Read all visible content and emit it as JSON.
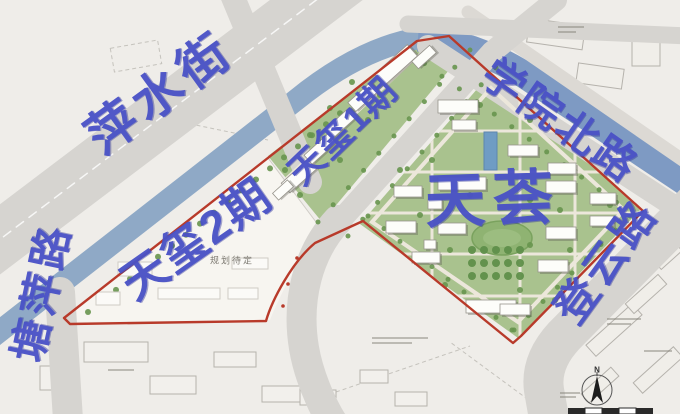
{
  "map": {
    "labels": [
      {
        "id": "pingshui-street",
        "text": "萍水街",
        "x": 160,
        "y": 93,
        "rot": -36,
        "size": 50,
        "ls": 6
      },
      {
        "id": "tangping-road",
        "text": "塘萍路",
        "x": 42,
        "y": 292,
        "rot": -78,
        "size": 42,
        "ls": 5
      },
      {
        "id": "xueyuan-north-road",
        "text": "学院北路",
        "x": 560,
        "y": 121,
        "rot": 35,
        "size": 42,
        "ls": 3
      },
      {
        "id": "dengyun-road",
        "text": "登云路",
        "x": 607,
        "y": 262,
        "rot": -54,
        "size": 43,
        "ls": 4
      },
      {
        "id": "tianxi-phase-2",
        "text": "天玺2期",
        "x": 196,
        "y": 239,
        "rot": -35,
        "size": 46,
        "ls": 2
      },
      {
        "id": "tianxi-phase-1",
        "text": "天玺1期",
        "x": 343,
        "y": 131,
        "rot": -44,
        "size": 36,
        "ls": 2
      },
      {
        "id": "tianhui",
        "text": "天荟",
        "x": 493,
        "y": 200,
        "rot": -2,
        "size": 60,
        "ls": 8
      }
    ],
    "annotations": {
      "pending": "规划待定"
    },
    "compass": {
      "north": "N"
    },
    "colors": {
      "bg": "#efede9",
      "road": "#d6d4d0",
      "river1": "#8fa9c6",
      "river2": "#7e9ac3",
      "green": "#a9c28e",
      "tree": "#67954e",
      "bldg": "#fdfdfa",
      "bstroke": "#97948c",
      "red": "#b83a2a",
      "blue": "#4a52c6",
      "path": "#ece7db",
      "pool": "#6f9cc4",
      "oval": "#8fb372",
      "white2": "#f7f5f0",
      "ctx": "#b5b2ac",
      "dash": "#b3b0aa"
    },
    "features": {
      "tianhui_buildings": [
        [
          438,
          100,
          40,
          13
        ],
        [
          452,
          120,
          24,
          10
        ],
        [
          508,
          145,
          30,
          11
        ],
        [
          548,
          163,
          28,
          11
        ],
        [
          590,
          193,
          26,
          11
        ],
        [
          394,
          186,
          28,
          11
        ],
        [
          438,
          177,
          48,
          13
        ],
        [
          546,
          181,
          30,
          12
        ],
        [
          386,
          221,
          30,
          12
        ],
        [
          438,
          223,
          28,
          11
        ],
        [
          546,
          227,
          30,
          12
        ],
        [
          590,
          216,
          24,
          10
        ],
        [
          412,
          252,
          28,
          11
        ],
        [
          538,
          260,
          30,
          12
        ],
        [
          466,
          300,
          50,
          13
        ],
        [
          500,
          304,
          30,
          11
        ],
        [
          428,
          199,
          14,
          10
        ],
        [
          424,
          240,
          12,
          9
        ]
      ],
      "tianxi1_buildings": [
        [
          299,
          176,
          36,
          13
        ],
        [
          320,
          149,
          32,
          12
        ],
        [
          341,
          123,
          32,
          12
        ],
        [
          363,
          97,
          30,
          12
        ],
        [
          396,
          65,
          44,
          15
        ],
        [
          424,
          57,
          24,
          10
        ],
        [
          283,
          190,
          20,
          9
        ]
      ],
      "future_outlines": [
        [
          118,
          262,
          34,
          14
        ],
        [
          158,
          288,
          62,
          11
        ],
        [
          228,
          288,
          30,
          11
        ],
        [
          96,
          292,
          24,
          13
        ],
        [
          232,
          258,
          36,
          11
        ]
      ],
      "context_buildings": [
        [
          84,
          342,
          64,
          20
        ],
        [
          40,
          366,
          30,
          24
        ],
        [
          150,
          376,
          46,
          18
        ],
        [
          214,
          352,
          42,
          15
        ],
        [
          262,
          386,
          38,
          16
        ],
        [
          300,
          390,
          36,
          15
        ],
        [
          360,
          370,
          28,
          13
        ],
        [
          395,
          392,
          32,
          14
        ]
      ],
      "context_buildings_rot": [
        [
          614,
          330,
          62,
          15,
          -42
        ],
        [
          646,
          294,
          44,
          13,
          -42
        ],
        [
          658,
          370,
          54,
          14,
          -42
        ],
        [
          600,
          385,
          40,
          12,
          -42
        ],
        [
          668,
          256,
          28,
          11,
          -42
        ],
        [
          556,
          34,
          56,
          24,
          8
        ],
        [
          600,
          76,
          46,
          20,
          8
        ],
        [
          646,
          48,
          28,
          36,
          0
        ]
      ],
      "tree_lines": [
        {
          "from": [
            88,
            312
          ],
          "to": [
            410,
            58
          ],
          "n": 24,
          "r": 3
        },
        {
          "from": [
            318,
            222
          ],
          "to": [
            470,
            50
          ],
          "n": 11,
          "r": 2.5
        },
        {
          "from": [
            348,
            236
          ],
          "to": [
            496,
            68
          ],
          "n": 11,
          "r": 2.5
        },
        {
          "from": [
            407,
            51
          ],
          "to": [
            634,
            215
          ],
          "n": 14,
          "r": 2.5
        },
        {
          "from": [
            630,
            216
          ],
          "to": [
            514,
            330
          ],
          "n": 9,
          "r": 2.5
        },
        {
          "from": [
            368,
            216
          ],
          "to": [
            512,
            330
          ],
          "n": 10,
          "r": 2.5
        }
      ],
      "tree_spots": [
        [
          400,
          170
        ],
        [
          432,
          160
        ],
        [
          470,
          195
        ],
        [
          530,
          200
        ],
        [
          560,
          210
        ],
        [
          610,
          205
        ],
        [
          450,
          250
        ],
        [
          530,
          245
        ],
        [
          570,
          250
        ],
        [
          445,
          285
        ],
        [
          520,
          290
        ],
        [
          555,
          300
        ],
        [
          480,
          105
        ],
        [
          530,
          120
        ],
        [
          420,
          215
        ],
        [
          285,
          170
        ],
        [
          310,
          135
        ],
        [
          330,
          108
        ],
        [
          352,
          82
        ],
        [
          380,
          95
        ],
        [
          340,
          160
        ],
        [
          300,
          195
        ],
        [
          368,
          120
        ]
      ],
      "orchard": {
        "x0": 472,
        "y0": 250,
        "cols": 5,
        "rows": 3,
        "dx": 12,
        "dy": 13,
        "r": 4
      },
      "red_ticks": [
        [
          297,
          258
        ],
        [
          288,
          284
        ],
        [
          283,
          306
        ]
      ]
    }
  }
}
